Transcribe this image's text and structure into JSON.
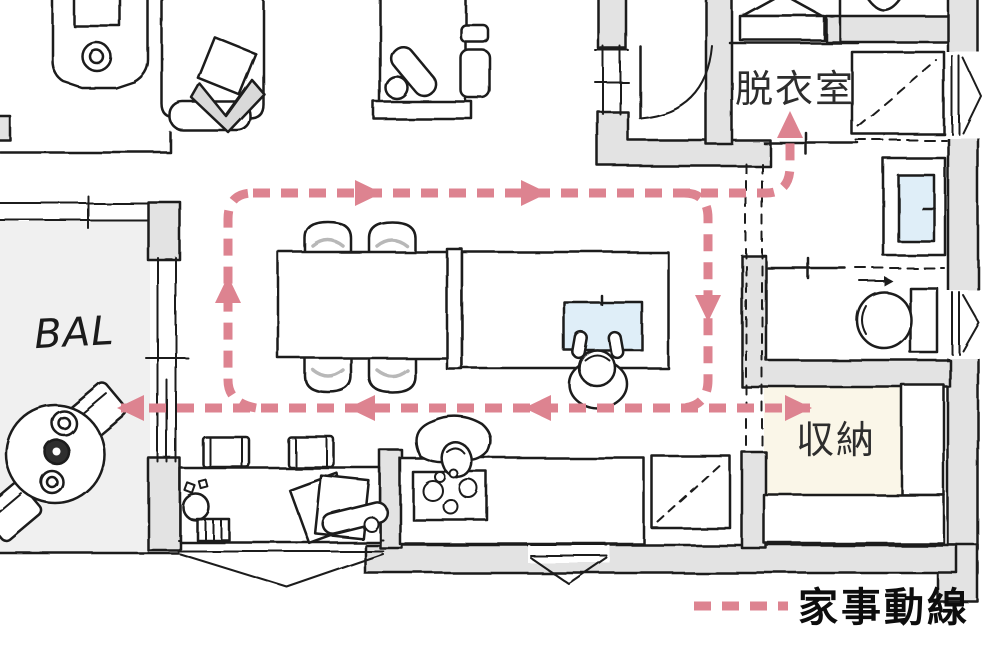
{
  "colors": {
    "flow_line": "#dd8390",
    "wall_fill": "#e3e3e3",
    "outline": "#1b1b1b",
    "balcony_floor": "#f0f0f0",
    "storage_floor": "#faf6e8",
    "sink_blue": "#dfeef8",
    "pillow_gray": "#d9d9d9"
  },
  "labels": {
    "balcony": "BAL",
    "dressing_room": "脱衣室",
    "storage": "収納",
    "legend": "家事動線"
  },
  "flow": {
    "name": "家事動線 (housework flow line)",
    "style": {
      "dash": "17 11",
      "width": 9
    },
    "paths": [
      {
        "name": "loop-top-and-branch-to-dressing-room",
        "d": "M253,193 H766 Q790,193 790,166 V138"
      },
      {
        "name": "loop-right-side",
        "d": "M684,193 Q708,193 708,218 V380 Q708,407 681,408"
      },
      {
        "name": "bottom-run-storage-to-balcony",
        "d": "M810,408 H120"
      },
      {
        "name": "loop-left-side",
        "d": "M256,408 Q228,403 228,380 V219 Q228,193 253,193"
      }
    ],
    "arrows": [
      {
        "x": 366,
        "y": 193,
        "dir": "right"
      },
      {
        "x": 532,
        "y": 193,
        "dir": "right"
      },
      {
        "x": 790,
        "y": 127,
        "dir": "up"
      },
      {
        "x": 708,
        "y": 306,
        "dir": "down"
      },
      {
        "x": 540,
        "y": 408,
        "dir": "left"
      },
      {
        "x": 364,
        "y": 408,
        "dir": "left"
      },
      {
        "x": 133,
        "y": 408,
        "dir": "left"
      },
      {
        "x": 796,
        "y": 408,
        "dir": "right"
      },
      {
        "x": 228,
        "y": 292,
        "dir": "up"
      }
    ],
    "legend_line_d": "M694,606 H788"
  }
}
